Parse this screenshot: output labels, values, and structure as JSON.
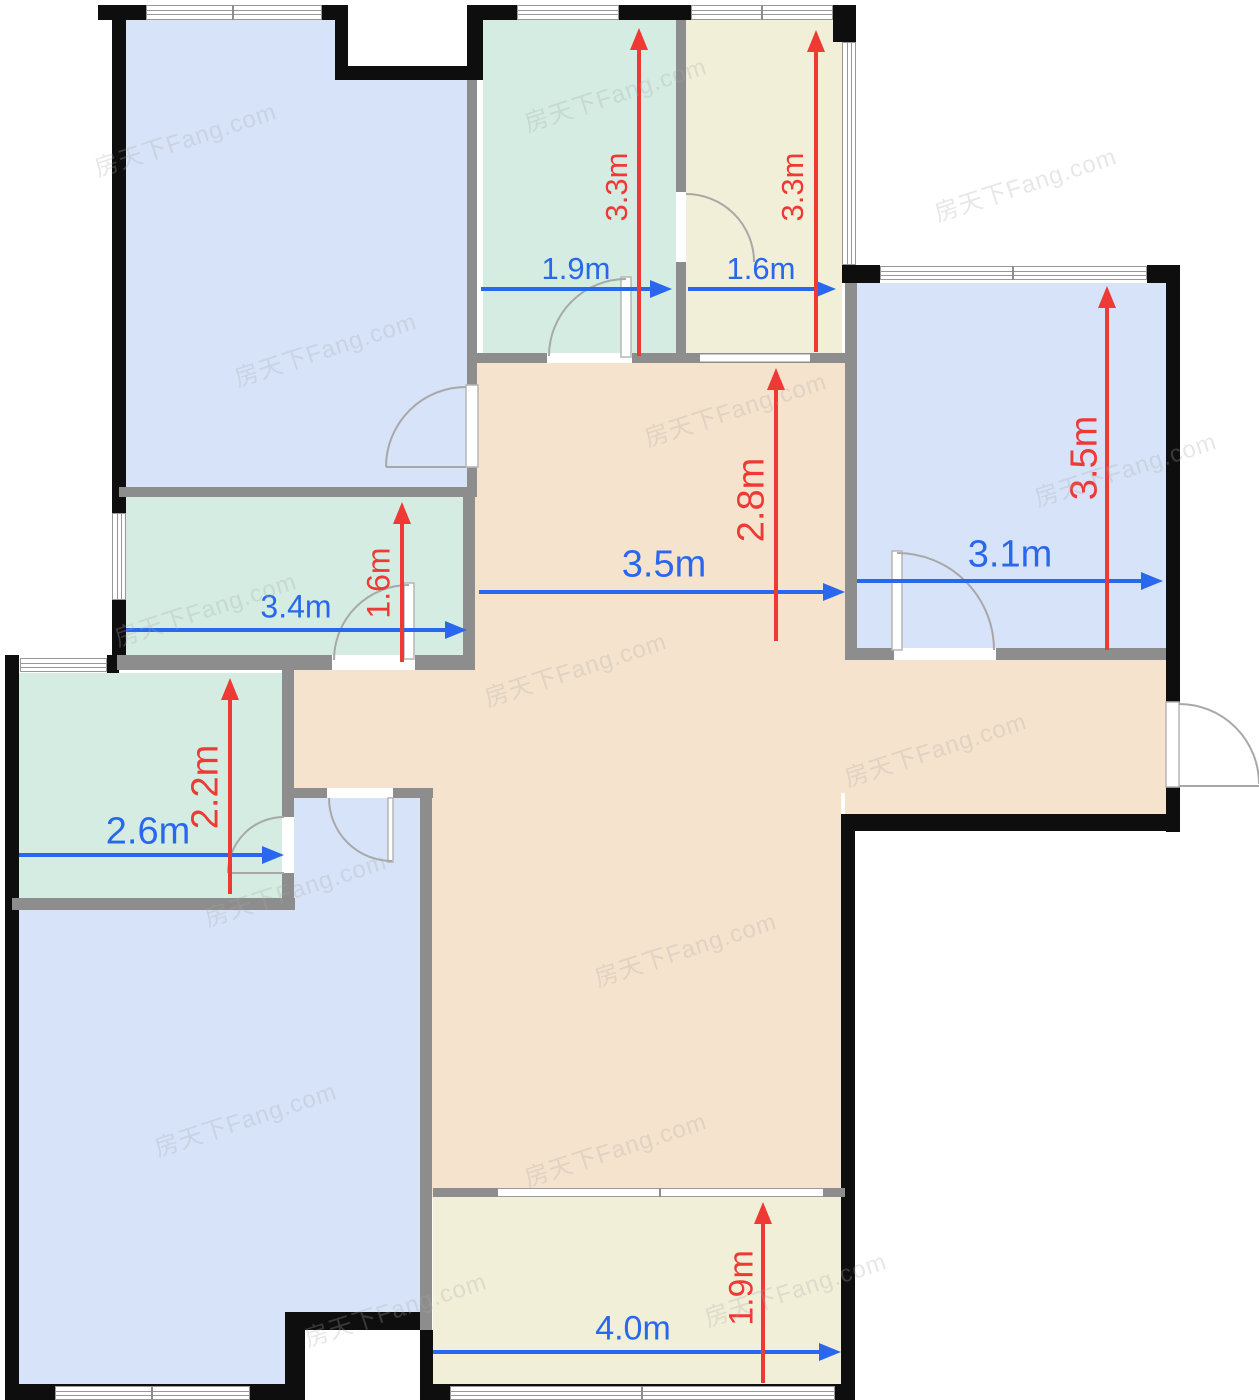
{
  "watermark": {
    "text": "房天下Fang.com"
  },
  "colors": {
    "room_blue": "#d7e3f9",
    "room_green": "#d4ece2",
    "room_cream": "#f1efd8",
    "hall_tan": "#f5e3cd",
    "wall_exterior": "#0e0e0e",
    "wall_interior": "#8d8d8d",
    "dim_blue": "#2968ee",
    "dim_red": "#ee3934"
  },
  "dims": {
    "north_room_w": "1.9m",
    "north_room_h": "3.3m",
    "north_bath_w": "1.6m",
    "north_bath_h": "3.3m",
    "bedroom_right_w": "3.1m",
    "bedroom_right_h": "3.5m",
    "hall_w": "3.5m",
    "hall_h": "2.8m",
    "kitchen_w": "3.4m",
    "kitchen_h": "1.6m",
    "bathroom_w": "2.6m",
    "bathroom_h": "2.2m",
    "balcony_w": "4.0m",
    "balcony_h": "1.9m"
  }
}
